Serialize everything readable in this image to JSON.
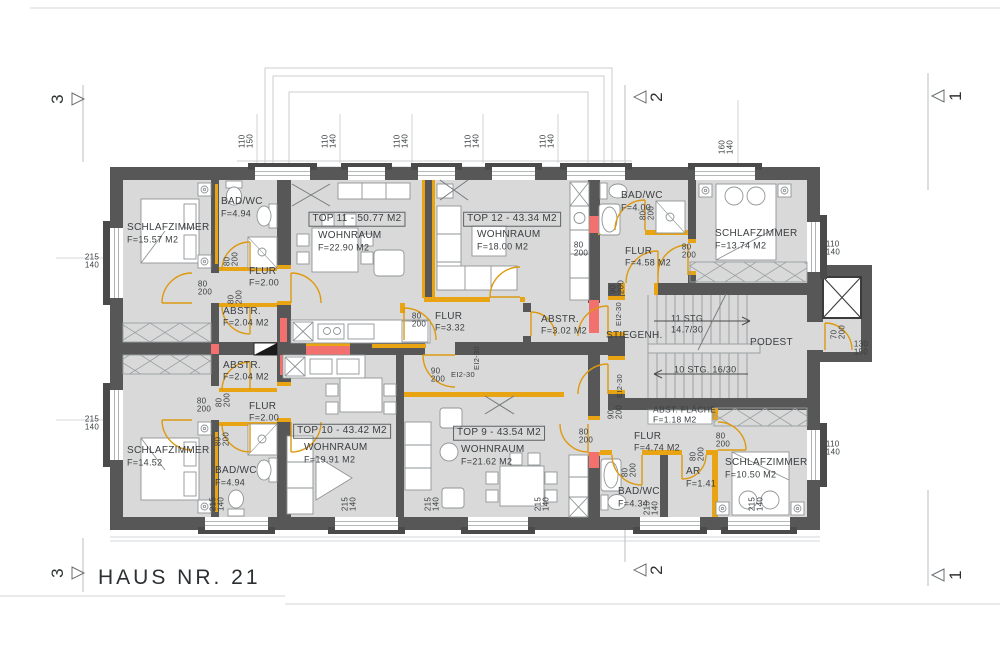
{
  "title": "HAUS NR. 21",
  "colors": {
    "wall": "#575757",
    "room_fill": "#d9d9d9",
    "door_accent": "#dd9a10",
    "shaft_red": "#f2706d"
  },
  "annotations": [
    {
      "t": "SCHLAFZIMMER",
      "x": 127,
      "y": 228,
      "k": "room"
    },
    {
      "t": "F=15.57 M2",
      "x": 127,
      "y": 240,
      "s": 9,
      "k": "area"
    },
    {
      "t": "BAD/WC",
      "x": 221,
      "y": 202,
      "k": "room"
    },
    {
      "t": "F=4.94",
      "x": 221,
      "y": 214,
      "s": 9,
      "k": "area"
    },
    {
      "t": "FLUR",
      "x": 249,
      "y": 272,
      "k": "room"
    },
    {
      "t": "F=2.00",
      "x": 249,
      "y": 283,
      "s": 9,
      "k": "area"
    },
    {
      "t": "ABSTR.",
      "x": 223,
      "y": 312,
      "k": "room"
    },
    {
      "t": "F=2.04 M2",
      "x": 223,
      "y": 323,
      "s": 9,
      "k": "area"
    },
    {
      "t": "TOP 11 - 50.77 M2",
      "x": 357,
      "y": 219,
      "a": "c",
      "b": 1,
      "k": "unit"
    },
    {
      "t": "WOHNRAUM",
      "x": 318,
      "y": 236,
      "k": "room"
    },
    {
      "t": "F=22.90 M2",
      "x": 318,
      "y": 248,
      "s": 9,
      "k": "area"
    },
    {
      "t": "TOP 12 - 43.34 M2",
      "x": 512,
      "y": 219,
      "a": "c",
      "b": 1,
      "k": "unit"
    },
    {
      "t": "WOHNRAUM",
      "x": 477,
      "y": 235,
      "k": "room"
    },
    {
      "t": "F=18.00 M2",
      "x": 477,
      "y": 247,
      "s": 9,
      "k": "area"
    },
    {
      "t": "BAD/WC",
      "x": 621,
      "y": 196,
      "k": "room"
    },
    {
      "t": "F=4.00",
      "x": 621,
      "y": 208,
      "s": 9,
      "k": "area"
    },
    {
      "t": "FLUR",
      "x": 625,
      "y": 252,
      "k": "room"
    },
    {
      "t": "F=4.58 M2",
      "x": 625,
      "y": 263,
      "s": 9,
      "k": "area"
    },
    {
      "t": "SCHLAFZIMMER",
      "x": 715,
      "y": 234,
      "k": "room"
    },
    {
      "t": "F=13.74 M2",
      "x": 715,
      "y": 246,
      "s": 9,
      "k": "area"
    },
    {
      "t": "FLUR",
      "x": 435,
      "y": 317,
      "k": "room"
    },
    {
      "t": "F=3.32",
      "x": 435,
      "y": 328,
      "s": 9,
      "k": "area"
    },
    {
      "t": "ABSTR.",
      "x": 541,
      "y": 320,
      "k": "room"
    },
    {
      "t": "F=3.02 M2",
      "x": 541,
      "y": 331,
      "s": 9,
      "k": "area"
    },
    {
      "t": "STIEGENH.",
      "x": 606,
      "y": 336,
      "k": "room"
    },
    {
      "t": "11 STG.",
      "x": 671,
      "y": 319,
      "s": 9,
      "k": "stair"
    },
    {
      "t": "14.7/30",
      "x": 671,
      "y": 330,
      "s": 9,
      "k": "stair"
    },
    {
      "t": "10 STG. 16/30",
      "x": 674,
      "y": 370,
      "s": 9,
      "k": "stair"
    },
    {
      "t": "PODEST",
      "x": 750,
      "y": 343,
      "k": "room"
    },
    {
      "t": "ABST. FLÄCHE",
      "x": 653,
      "y": 410,
      "s": 8.5,
      "k": "room"
    },
    {
      "t": "F=1.18 M2",
      "x": 653,
      "y": 420,
      "s": 8.5,
      "k": "area"
    },
    {
      "t": "FLUR",
      "x": 634,
      "y": 437,
      "k": "room"
    },
    {
      "t": "F=4.74 M2",
      "x": 634,
      "y": 448,
      "s": 9,
      "k": "area"
    },
    {
      "t": "ABSTR.",
      "x": 223,
      "y": 366,
      "k": "room"
    },
    {
      "t": "F=2.04 M2",
      "x": 223,
      "y": 377,
      "s": 9,
      "k": "area"
    },
    {
      "t": "FLUR",
      "x": 249,
      "y": 407,
      "k": "room"
    },
    {
      "t": "F=2.00",
      "x": 249,
      "y": 418,
      "s": 9,
      "k": "area"
    },
    {
      "t": "SCHLAFZIMMER",
      "x": 127,
      "y": 451,
      "k": "room"
    },
    {
      "t": "F=14.52",
      "x": 127,
      "y": 463,
      "s": 9,
      "k": "area"
    },
    {
      "t": "BAD/WC",
      "x": 215,
      "y": 471,
      "k": "room"
    },
    {
      "t": "F=4.94",
      "x": 215,
      "y": 483,
      "s": 9,
      "k": "area"
    },
    {
      "t": "TOP 10 - 43.42 M2",
      "x": 342,
      "y": 431,
      "a": "c",
      "b": 1,
      "k": "unit"
    },
    {
      "t": "WOHNRAUM",
      "x": 304,
      "y": 448,
      "k": "room"
    },
    {
      "t": "F=19.91 M2",
      "x": 304,
      "y": 460,
      "s": 9,
      "k": "area"
    },
    {
      "t": "TOP 9 - 43.54 M2",
      "x": 499,
      "y": 433,
      "a": "c",
      "b": 1,
      "k": "unit"
    },
    {
      "t": "WOHNRAUM",
      "x": 461,
      "y": 450,
      "k": "room"
    },
    {
      "t": "F=21.62 M2",
      "x": 461,
      "y": 462,
      "s": 9,
      "k": "area"
    },
    {
      "t": "BAD/WC",
      "x": 618,
      "y": 492,
      "k": "room"
    },
    {
      "t": "F=4.34",
      "x": 618,
      "y": 504,
      "s": 9,
      "k": "area"
    },
    {
      "t": "AR",
      "x": 686,
      "y": 472,
      "k": "room"
    },
    {
      "t": "F=1.41",
      "x": 686,
      "y": 484,
      "s": 9,
      "k": "area"
    },
    {
      "t": "SCHLAFZIMMER",
      "x": 725,
      "y": 463,
      "k": "room"
    },
    {
      "t": "F=10.50 M2",
      "x": 725,
      "y": 475,
      "s": 9,
      "k": "area"
    },
    {
      "t": "110|150",
      "x": 247,
      "y": 141,
      "r": -90,
      "s": 8,
      "k": "dim"
    },
    {
      "t": "110|140",
      "x": 330,
      "y": 141,
      "r": -90,
      "s": 8,
      "k": "dim"
    },
    {
      "t": "110|140",
      "x": 402,
      "y": 141,
      "r": -90,
      "s": 8,
      "k": "dim"
    },
    {
      "t": "110|140",
      "x": 473,
      "y": 141,
      "r": -90,
      "s": 8,
      "k": "dim"
    },
    {
      "t": "110|140",
      "x": 548,
      "y": 141,
      "r": -90,
      "s": 8,
      "k": "dim"
    },
    {
      "t": "160|140",
      "x": 727,
      "y": 147,
      "r": -90,
      "s": 8,
      "k": "dim"
    },
    {
      "t": "215|140",
      "x": 92,
      "y": 262,
      "a": "c",
      "s": 8,
      "k": "dim"
    },
    {
      "t": "215|140",
      "x": 92,
      "y": 424,
      "a": "c",
      "s": 8,
      "k": "dim"
    },
    {
      "t": "110|140",
      "x": 833,
      "y": 249,
      "a": "c",
      "s": 8,
      "k": "dim"
    },
    {
      "t": "110|140",
      "x": 833,
      "y": 449,
      "a": "c",
      "s": 8,
      "k": "dim"
    },
    {
      "t": "130|150",
      "x": 861,
      "y": 349,
      "a": "c",
      "s": 8,
      "k": "dim"
    },
    {
      "t": "70|200",
      "x": 839,
      "y": 332,
      "r": -90,
      "s": 8,
      "k": "dim"
    },
    {
      "t": "215|140",
      "x": 218,
      "y": 504,
      "r": -90,
      "s": 8,
      "k": "dim"
    },
    {
      "t": "215|140",
      "x": 350,
      "y": 504,
      "r": -90,
      "s": 8,
      "k": "dim"
    },
    {
      "t": "215|140",
      "x": 433,
      "y": 504,
      "r": -90,
      "s": 8,
      "k": "dim"
    },
    {
      "t": "215|140",
      "x": 543,
      "y": 504,
      "r": -90,
      "s": 8,
      "k": "dim"
    },
    {
      "t": "215|140",
      "x": 652,
      "y": 508,
      "r": -90,
      "s": 8,
      "k": "dim"
    },
    {
      "t": "215|140",
      "x": 757,
      "y": 504,
      "r": -90,
      "s": 8,
      "k": "dim"
    },
    {
      "t": "80|200",
      "x": 205,
      "y": 289,
      "a": "c",
      "s": 8,
      "k": "door"
    },
    {
      "t": "80|200",
      "x": 232,
      "y": 259,
      "r": -90,
      "s": 8,
      "k": "door"
    },
    {
      "t": "80|200",
      "x": 236,
      "y": 297,
      "r": -90,
      "s": 8,
      "k": "door"
    },
    {
      "t": "80|200",
      "x": 204,
      "y": 406,
      "a": "c",
      "s": 8,
      "k": "door"
    },
    {
      "t": "80|200",
      "x": 224,
      "y": 400,
      "r": -90,
      "s": 8,
      "k": "door"
    },
    {
      "t": "80|200",
      "x": 223,
      "y": 439,
      "r": -90,
      "s": 8,
      "k": "door"
    },
    {
      "t": "80|200",
      "x": 419,
      "y": 321,
      "a": "c",
      "s": 8,
      "k": "door"
    },
    {
      "t": "80|200",
      "x": 581,
      "y": 250,
      "a": "c",
      "s": 8,
      "k": "door"
    },
    {
      "t": "80|200",
      "x": 648,
      "y": 213,
      "r": -90,
      "s": 8,
      "k": "door"
    },
    {
      "t": "80|200",
      "x": 689,
      "y": 252,
      "a": "c",
      "s": 8,
      "k": "door"
    },
    {
      "t": "90|200",
      "x": 618,
      "y": 287,
      "r": -90,
      "s": 8,
      "k": "door"
    },
    {
      "t": "90|200",
      "x": 616,
      "y": 412,
      "r": -90,
      "s": 8,
      "k": "door"
    },
    {
      "t": "90|200",
      "x": 438,
      "y": 376,
      "a": "c",
      "s": 8,
      "k": "door"
    },
    {
      "t": "80|200",
      "x": 586,
      "y": 437,
      "a": "c",
      "s": 8,
      "k": "door"
    },
    {
      "t": "80|200",
      "x": 723,
      "y": 441,
      "a": "c",
      "s": 8,
      "k": "door"
    },
    {
      "t": "80|200",
      "x": 630,
      "y": 470,
      "r": -90,
      "s": 8,
      "k": "door"
    },
    {
      "t": "80|200",
      "x": 698,
      "y": 454,
      "r": -90,
      "s": 8,
      "k": "door"
    },
    {
      "t": "EI2-30",
      "x": 619,
      "y": 314,
      "r": -90,
      "s": 7.5,
      "k": "fire"
    },
    {
      "t": "EI2-30",
      "x": 620,
      "y": 386,
      "r": -90,
      "s": 7.5,
      "k": "fire"
    },
    {
      "t": "EI2-30",
      "x": 477,
      "y": 358,
      "r": -90,
      "s": 7.5,
      "k": "fire"
    },
    {
      "t": "EI2-30",
      "x": 463,
      "y": 375,
      "a": "c",
      "s": 7.5,
      "k": "fire"
    },
    {
      "t": "3",
      "x": 58,
      "y": 99,
      "r": -90,
      "s": 17,
      "k": "marker"
    },
    {
      "t": "2",
      "x": 657,
      "y": 97,
      "r": -90,
      "s": 17,
      "k": "marker"
    },
    {
      "t": "1",
      "x": 956,
      "y": 96,
      "r": -90,
      "s": 17,
      "k": "marker"
    },
    {
      "t": "3",
      "x": 58,
      "y": 573,
      "r": -90,
      "s": 17,
      "k": "marker"
    },
    {
      "t": "2",
      "x": 657,
      "y": 570,
      "r": -90,
      "s": 17,
      "k": "marker"
    },
    {
      "t": "1",
      "x": 956,
      "y": 575,
      "r": -90,
      "s": 17,
      "k": "marker"
    }
  ]
}
